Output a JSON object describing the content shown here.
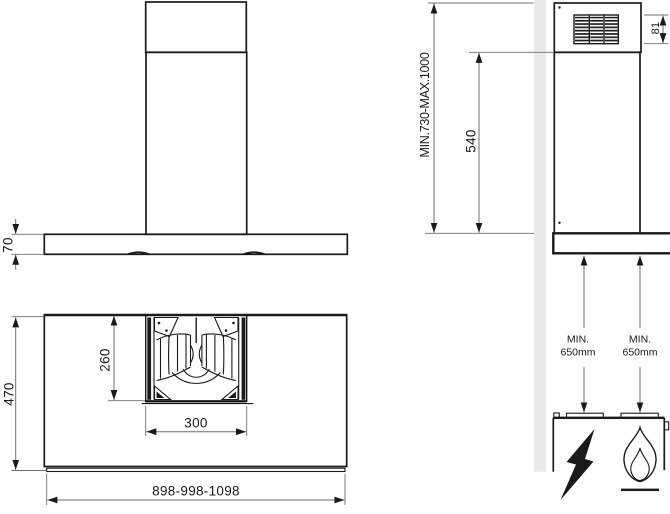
{
  "front_view": {
    "canopy_height": "70"
  },
  "side_view": {
    "total_height_range": "MIN.730-MAX.1000",
    "body_height": "540",
    "grille_height": "81"
  },
  "plan_view": {
    "depth": "470",
    "motor_housing_depth": "260",
    "motor_housing_width": "300",
    "width_options": "898-998-1098"
  },
  "clearance": {
    "left": {
      "line1": "MIN.",
      "line2": "650mm"
    },
    "right": {
      "line1": "MIN.",
      "line2": "650mm"
    }
  },
  "icons": {
    "electric_hob": "lightning-bolt",
    "gas_hob": "flame"
  },
  "colors": {
    "line": "#1a1a1a",
    "dimension_line": "#6e6e6e",
    "wall_fill": "#e9e9e9",
    "background": "#ffffff"
  }
}
